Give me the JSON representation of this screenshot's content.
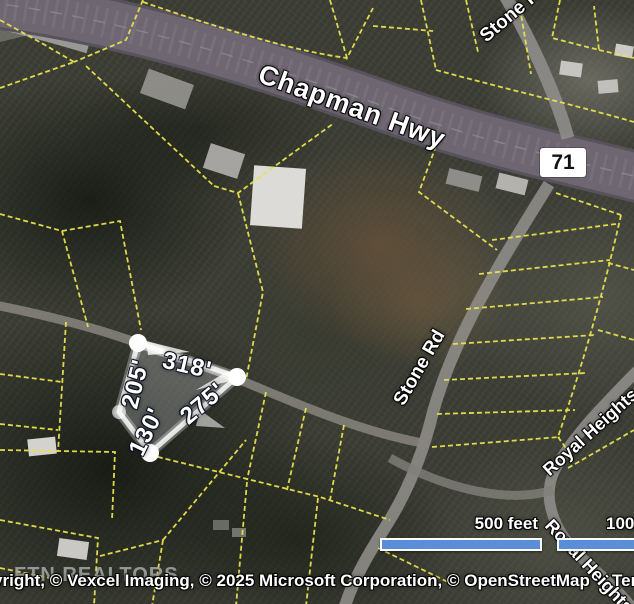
{
  "map_labels": {
    "chapman_hwy": "Chapman Hwy",
    "route_shield": "71",
    "stone_rd": "Stone Rd",
    "stone_rd_north": "Stone Rd",
    "royal_heights_upper": "Royal Heights",
    "royal_heights_lower": "Royal Heights"
  },
  "parcel_measurements": {
    "north_side": "318'",
    "east_side": "275'",
    "west_side": "205'",
    "south_side": "130'"
  },
  "scale_bar": {
    "primary": "500 feet",
    "secondary": "1000 feet"
  },
  "attribution": {
    "copyright": "Copyright, © Vexcel Imaging, © 2025 Microsoft Corporation, © OpenStreetMap",
    "terms": "Terms"
  },
  "watermark": "FTN REALTORS",
  "colors": {
    "parcel_line_yellow": "#e8e24e",
    "scale_bar_blue": "#5b8ed8",
    "selection_white": "#ffffff",
    "shield_bg": "#ffffff",
    "highway_fill": "#6e6671"
  }
}
